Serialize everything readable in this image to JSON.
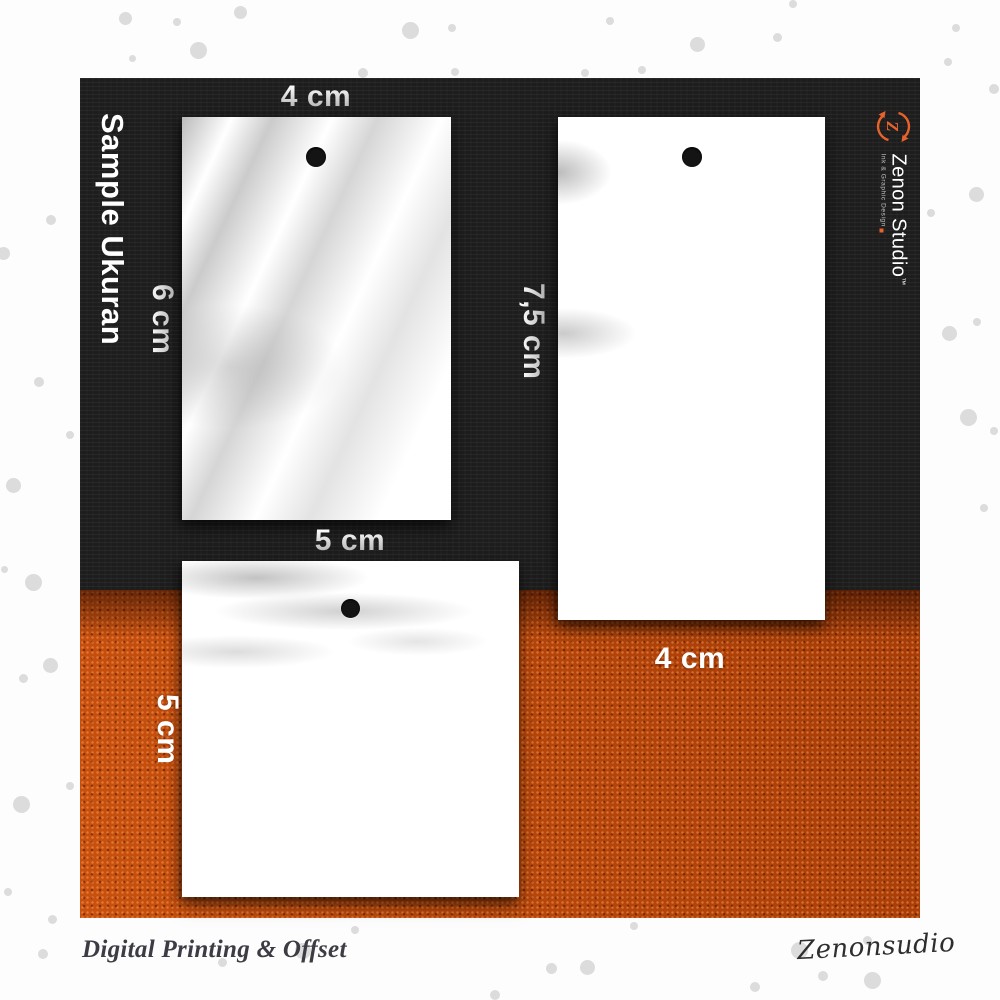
{
  "scene_title": "Sample Ukuran",
  "brand": {
    "name": "Zenon Studio",
    "trademark": "TM",
    "tagline": "Ink & Graphic Design"
  },
  "tags": [
    {
      "label_top": "4 cm",
      "label_side": "6 cm"
    },
    {
      "label_side": "7,5 cm",
      "label_bottom": "4 cm"
    },
    {
      "label_top": "5 cm",
      "label_side": "5 cm"
    }
  ],
  "footer": {
    "tagline": "Digital Printing & Offset",
    "signature": "Zenonsudio"
  },
  "colors": {
    "black_fabric": "#1d1d1d",
    "orange_fabric": "#c24708",
    "brand_orange": "#e8622c",
    "dot_gray": "#dcdcdc"
  },
  "decor": {
    "dots": [
      [
        125,
        18,
        13
      ],
      [
        177,
        22,
        8
      ],
      [
        240,
        12,
        13
      ],
      [
        198,
        50,
        17
      ],
      [
        132,
        58,
        7
      ],
      [
        410,
        30,
        17
      ],
      [
        452,
        28,
        8
      ],
      [
        363,
        73,
        10
      ],
      [
        455,
        72,
        8
      ],
      [
        610,
        21,
        8
      ],
      [
        697,
        44,
        15
      ],
      [
        777,
        37,
        9
      ],
      [
        793,
        4,
        8
      ],
      [
        585,
        73,
        8
      ],
      [
        642,
        70,
        8
      ],
      [
        956,
        28,
        8
      ],
      [
        948,
        62,
        8
      ],
      [
        994,
        89,
        10
      ],
      [
        976,
        194,
        15
      ],
      [
        931,
        213,
        8
      ],
      [
        949,
        333,
        15
      ],
      [
        977,
        322,
        8
      ],
      [
        968,
        417,
        17
      ],
      [
        994,
        431,
        8
      ],
      [
        984,
        508,
        8
      ],
      [
        51,
        220,
        10
      ],
      [
        3,
        253,
        13
      ],
      [
        39,
        382,
        10
      ],
      [
        70,
        435,
        8
      ],
      [
        13,
        485,
        15
      ],
      [
        4,
        569,
        7
      ],
      [
        33,
        582,
        17
      ],
      [
        50,
        665,
        15
      ],
      [
        23,
        678,
        9
      ],
      [
        70,
        786,
        8
      ],
      [
        21,
        804,
        17
      ],
      [
        8,
        892,
        8
      ],
      [
        52,
        919,
        9
      ],
      [
        43,
        954,
        10
      ],
      [
        634,
        926,
        8
      ],
      [
        587,
        967,
        15
      ],
      [
        799,
        950,
        17
      ],
      [
        867,
        940,
        9
      ],
      [
        823,
        976,
        10
      ],
      [
        872,
        980,
        17
      ],
      [
        755,
        987,
        10
      ],
      [
        551,
        968,
        11
      ],
      [
        495,
        995,
        10
      ],
      [
        222,
        962,
        9
      ],
      [
        303,
        951,
        16
      ],
      [
        355,
        930,
        8
      ]
    ]
  }
}
